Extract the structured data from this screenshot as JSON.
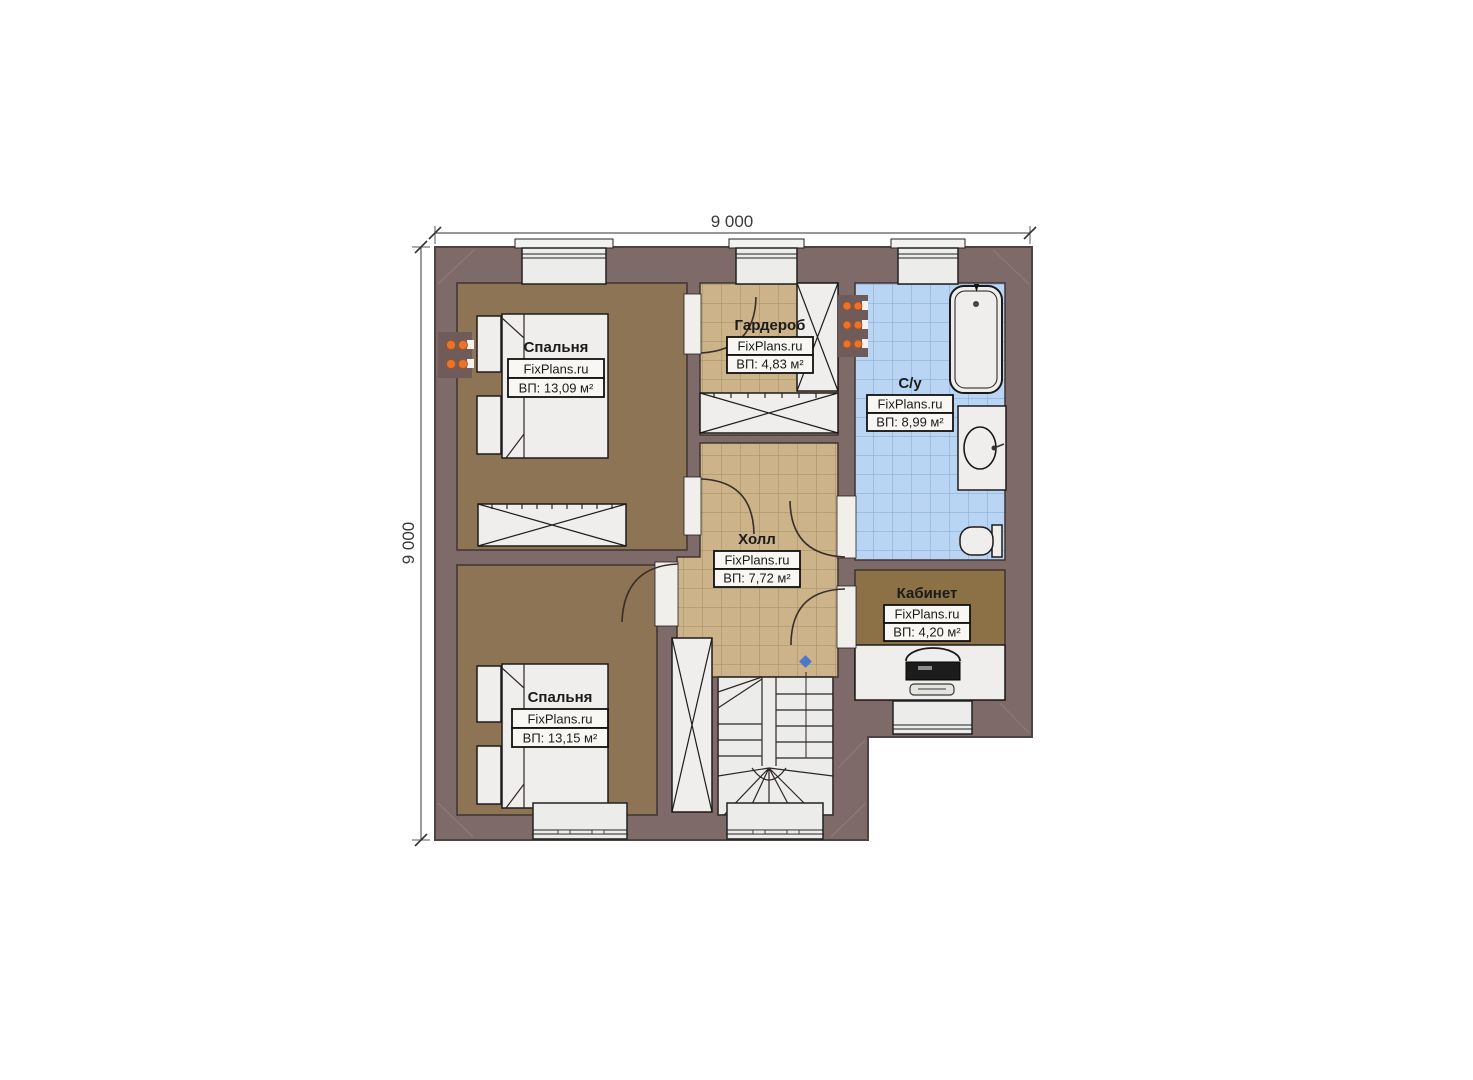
{
  "plan": {
    "title": "Second floor plan",
    "brand": "FixPlans.ru",
    "dimensions": {
      "top": "9 000",
      "left": "9 000"
    },
    "rooms": [
      {
        "id": "bedroom-top",
        "name": "Спальня",
        "brand": "FixPlans.ru",
        "area": "ВП: 13,09 м²"
      },
      {
        "id": "wardrobe",
        "name": "Гардероб",
        "brand": "FixPlans.ru",
        "area": "ВП: 4,83 м²"
      },
      {
        "id": "bathroom",
        "name": "С/у",
        "brand": "FixPlans.ru",
        "area": "ВП: 8,99 м²"
      },
      {
        "id": "hall",
        "name": "Холл",
        "brand": "FixPlans.ru",
        "area": "ВП: 7,72 м²"
      },
      {
        "id": "office",
        "name": "Кабинет",
        "brand": "FixPlans.ru",
        "area": "ВП: 4,20 м²"
      },
      {
        "id": "bedroom-bottom",
        "name": "Спальня",
        "brand": "FixPlans.ru",
        "area": "ВП: 13,15 м²"
      }
    ],
    "fixtures": [
      "bed",
      "nightstand",
      "wardrobe-cabinet",
      "bathtub",
      "sink",
      "toilet",
      "desk",
      "office-chair",
      "monitor",
      "keyboard",
      "staircase",
      "radiator",
      "window",
      "door",
      "stair-direction-marker"
    ],
    "colors": {
      "wall": "#7d6a69",
      "wall_edge": "#4f4242",
      "bedroom_floor": "#8d7454",
      "office_floor": "#8d7146",
      "tile_tan": "#ccb389",
      "tile_tan_grid": "#a08c64",
      "tile_blue": "#b9d5f3",
      "tile_blue_grid": "#7fa6d0",
      "fixture_white": "#efeeec",
      "radiator_orange": "#e8732c",
      "stair_marker_blue": "#4a79c8"
    }
  }
}
